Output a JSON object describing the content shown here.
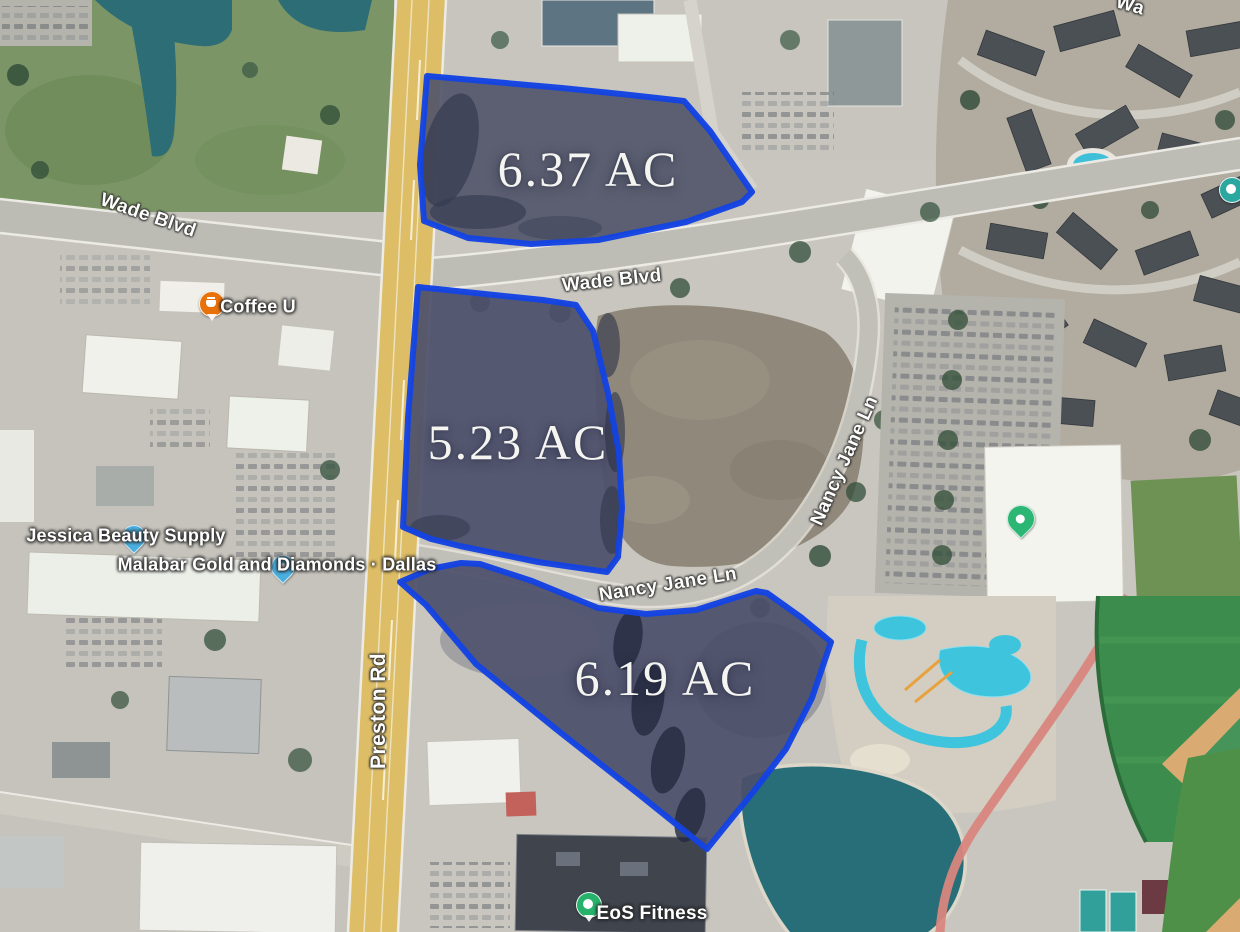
{
  "parcels": {
    "p1": {
      "label": "6.37 AC"
    },
    "p2": {
      "label": "5.23 AC"
    },
    "p3": {
      "label": "6.19 AC"
    }
  },
  "streets": {
    "wade_west": "Wade Blvd",
    "wade_center": "Wade Blvd",
    "wade_partial": "Wa",
    "preston": "Preston Rd",
    "nancy_curve": "Nancy Jane Ln",
    "nancy_south": "Nancy Jane Ln"
  },
  "places": {
    "coffee": {
      "label": "Coffee U",
      "icon": "coffee-pin",
      "color": "#e8710a"
    },
    "jessica": {
      "label": "Jessica Beauty Supply",
      "icon": "shopping-pin",
      "color": "#4aaede"
    },
    "malabar": {
      "label": "Malabar Gold and Diamonds · Dallas",
      "icon": "shopping-pin",
      "color": "#4aaede"
    },
    "eos": {
      "label": "EoS Fitness",
      "icon": "fitness-pin",
      "color": "#27b26b"
    },
    "building_pin": {
      "icon": "place-pin",
      "color": "#2bb673"
    },
    "edge_pin": {
      "icon": "place-pin",
      "color": "#2aa79f"
    }
  },
  "colors": {
    "parcel_outline": "#1443e2",
    "parcel_fill": "#4c506a",
    "label_text": "#ffffff",
    "road_major": "#ddbd66",
    "road_minor": "#c0bfb8",
    "water": "#2d6d75",
    "park_green": "#7c9566"
  }
}
